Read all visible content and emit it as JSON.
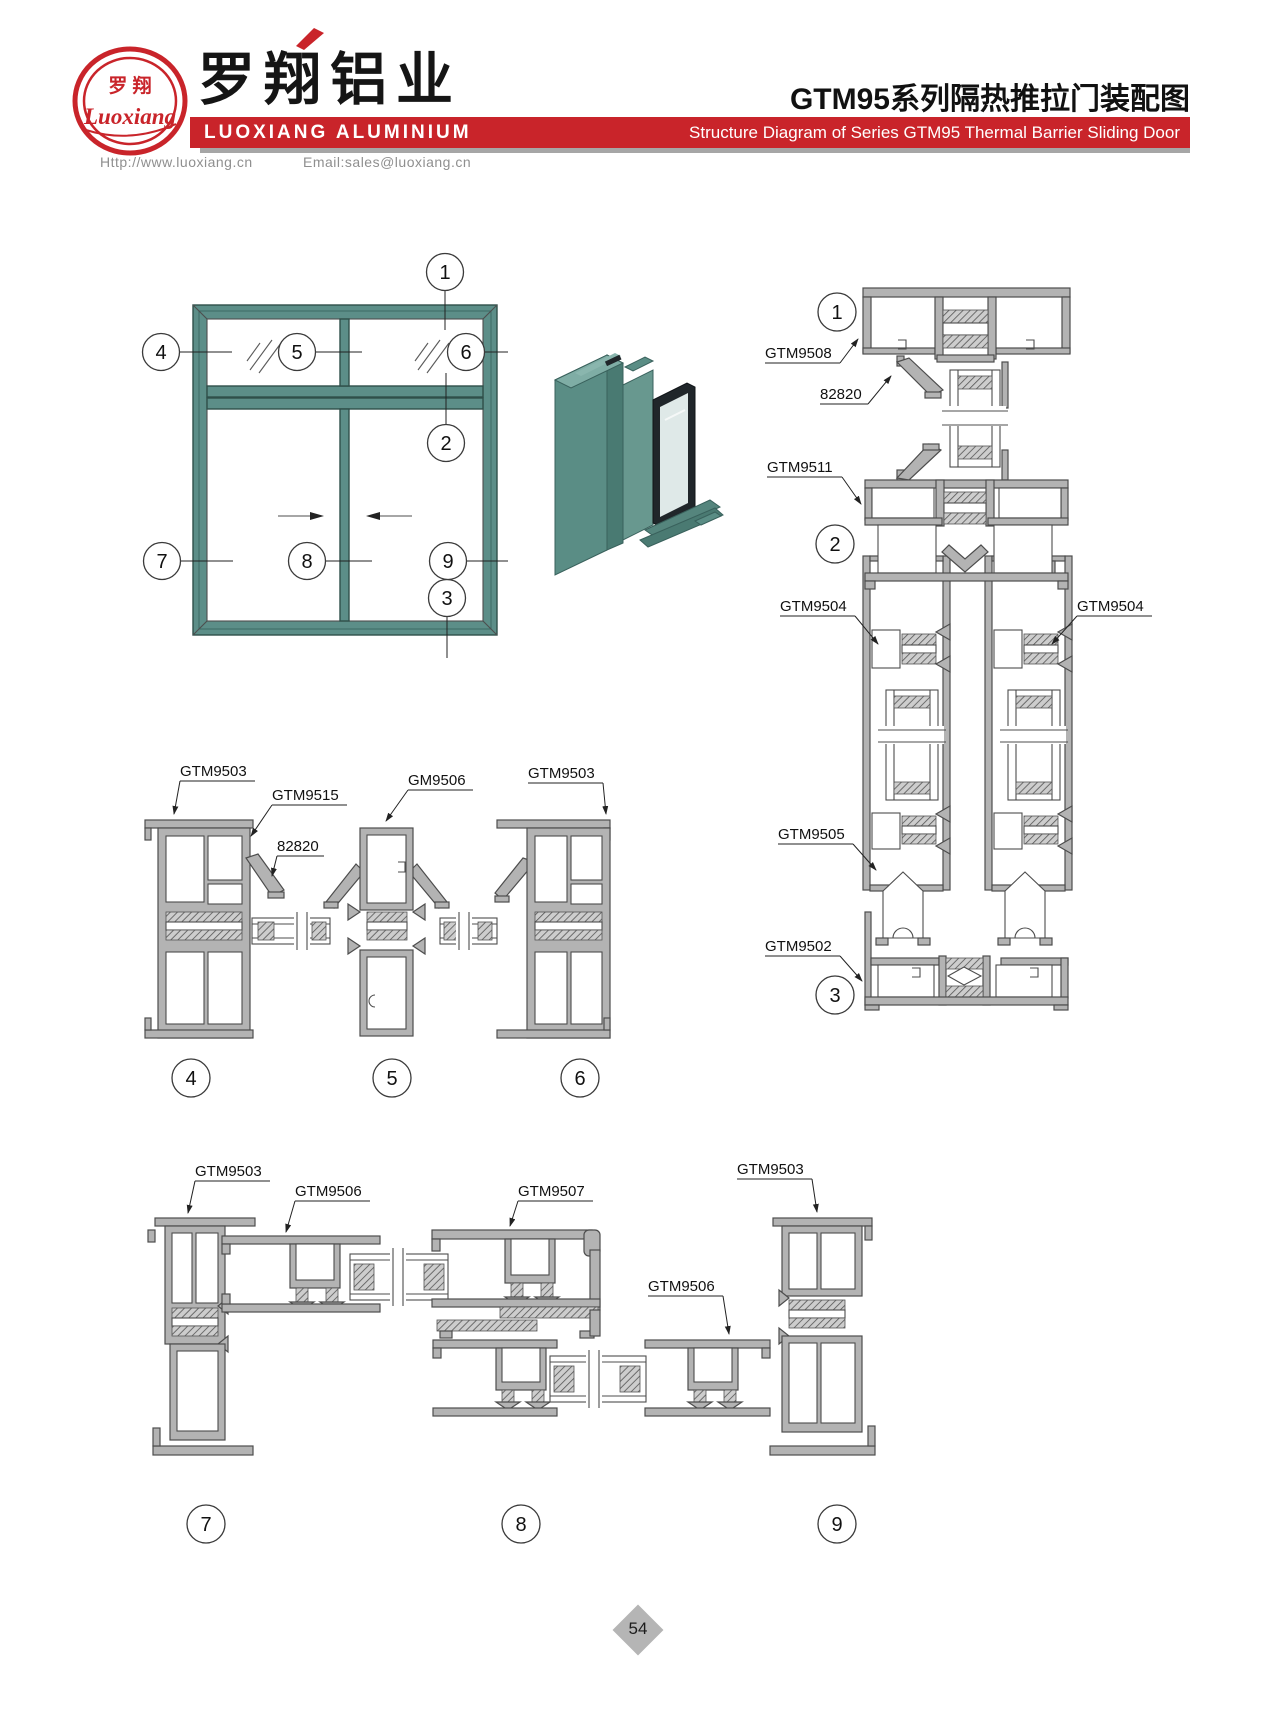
{
  "page": {
    "width": 1277,
    "height": 1721
  },
  "header": {
    "logo": {
      "cn": "罗 翔",
      "script": "Luoxiang"
    },
    "brand_cn": "罗翔铝业",
    "brand_en": "LUOXIANG ALUMINIUM",
    "title_cn": "GTM95系列隔热推拉门装配图",
    "title_en": "Structure Diagram of Series GTM95 Thermal Barrier Sliding Door",
    "website": "Http://www.luoxiang.cn",
    "email": "Email:sales@luoxiang.cn"
  },
  "colors": {
    "brand_red": "#c9242a",
    "frame_teal": "#5c8e88",
    "profile_gray": "#b3b3b3"
  },
  "elevation": {
    "callouts": [
      "1",
      "2",
      "3",
      "4",
      "5",
      "6",
      "7",
      "8",
      "9"
    ]
  },
  "right_column": {
    "labels": [
      "GTM9508",
      "82820",
      "GTM9511",
      "GTM9504",
      "GTM9504",
      "GTM9505",
      "GTM9502"
    ],
    "callouts": [
      "1",
      "2",
      "3"
    ]
  },
  "middle_group": {
    "labels": [
      "GTM9503",
      "GTM9515",
      "82820",
      "GM9506",
      "GTM9503"
    ],
    "callouts": [
      "4",
      "5",
      "6"
    ]
  },
  "bottom_group": {
    "labels": [
      "GTM9503",
      "GTM9506",
      "GTM9507",
      "GTM9503",
      "GTM9506"
    ],
    "callouts": [
      "7",
      "8",
      "9"
    ]
  },
  "footer": {
    "page_number": "54"
  }
}
